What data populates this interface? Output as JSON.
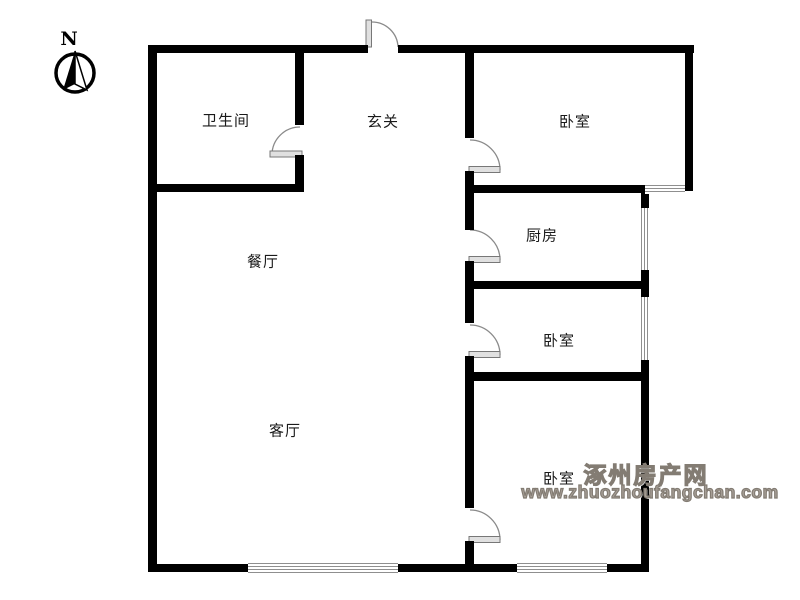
{
  "compass": {
    "label": "N"
  },
  "rooms": [
    {
      "id": "bathroom",
      "label": "卫生间"
    },
    {
      "id": "hallway",
      "label": "玄关"
    },
    {
      "id": "bedroom-top",
      "label": "卧室"
    },
    {
      "id": "kitchen",
      "label": "厨房"
    },
    {
      "id": "dining-room",
      "label": "餐厅"
    },
    {
      "id": "bedroom-middle",
      "label": "卧室"
    },
    {
      "id": "living-room",
      "label": "客厅"
    },
    {
      "id": "bedroom-bottom",
      "label": "卧室"
    }
  ],
  "watermark": {
    "site_name": "涿州房产网",
    "site_url": "www.zhuozhoufangchan.com"
  },
  "colors": {
    "wall": "#000000",
    "door_leaf": "#e0e0e0",
    "door_arc": "#8a8a8a",
    "window_line": "#8f8f8f",
    "watermark": "#a8a098"
  }
}
